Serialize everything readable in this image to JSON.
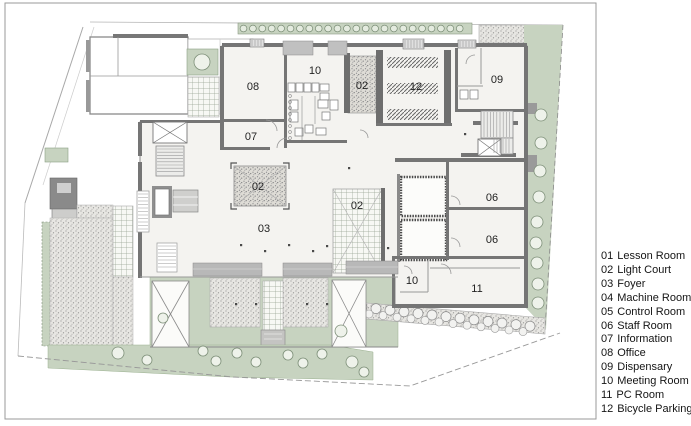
{
  "page": {
    "title": "Floor Plan with Room Legend"
  },
  "legend": {
    "items": [
      {
        "code": "01",
        "name": "Lesson Room"
      },
      {
        "code": "02",
        "name": "Light Court"
      },
      {
        "code": "03",
        "name": "Foyer"
      },
      {
        "code": "04",
        "name": "Machine Room"
      },
      {
        "code": "05",
        "name": "Control Room"
      },
      {
        "code": "06",
        "name": "Staff Room"
      },
      {
        "code": "07",
        "name": "Information"
      },
      {
        "code": "08",
        "name": "Office"
      },
      {
        "code": "09",
        "name": "Dispensary"
      },
      {
        "code": "10",
        "name": "Meeting Room"
      },
      {
        "code": "11",
        "name": "PC Room"
      },
      {
        "code": "12",
        "name": "Bicycle Parking"
      }
    ]
  },
  "plan": {
    "room_labels": [
      {
        "label": "08",
        "x": 253,
        "y": 90
      },
      {
        "label": "10",
        "x": 315,
        "y": 74
      },
      {
        "label": "02",
        "x": 362,
        "y": 89
      },
      {
        "label": "12",
        "x": 416,
        "y": 90
      },
      {
        "label": "09",
        "x": 497,
        "y": 83
      },
      {
        "label": "07",
        "x": 251,
        "y": 140
      },
      {
        "label": "02",
        "x": 258,
        "y": 190
      },
      {
        "label": "02",
        "x": 357,
        "y": 209
      },
      {
        "label": "03",
        "x": 264,
        "y": 232
      },
      {
        "label": "06",
        "x": 492,
        "y": 201
      },
      {
        "label": "06",
        "x": 492,
        "y": 243
      },
      {
        "label": "10",
        "x": 412,
        "y": 284
      },
      {
        "label": "11",
        "x": 477,
        "y": 292
      }
    ]
  },
  "colors": {
    "green": "#c7d3c0",
    "green_edge": "#8ba083",
    "wall": "#757575",
    "floor": "#f4f3f0",
    "canopy": "#b8b8b8",
    "dark_block": "#8a8a8a",
    "line": "#9a9a9a",
    "legend_text": "#151515"
  }
}
